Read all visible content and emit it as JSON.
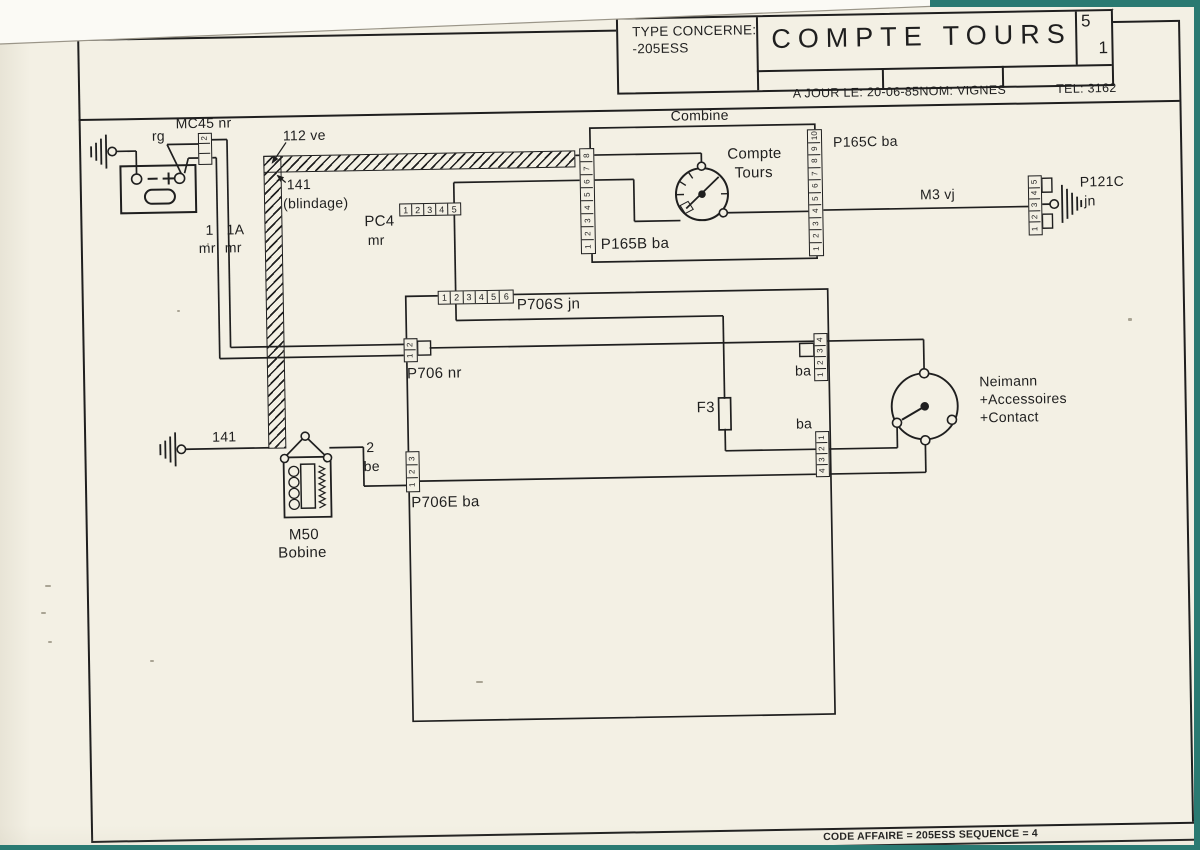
{
  "colors": {
    "paper": "#f3f0e4",
    "ink": "#1f1f1f",
    "scanner_teal": "#2a7a72"
  },
  "title_block": {
    "type_label": "TYPE CONCERNE:",
    "type_value": "-205ESS",
    "title": "COMPTE TOURS",
    "sheet_top": "5",
    "sheet_bottom": "1",
    "date_label": "A JOUR LE:",
    "date_value": "20-06-85",
    "name_label": "NOM:",
    "name_value": "VIGNES",
    "tel_label": "TEL:",
    "tel_value": "3162"
  },
  "footer": {
    "code_line": "CODE AFFAIRE = 205ESS SEQUENCE = 4"
  },
  "diagram": {
    "labels": [
      {
        "t": "MC45 nr",
        "x": 181,
        "y": 109,
        "fs": 14
      },
      {
        "t": "rg",
        "x": 157,
        "y": 121,
        "fs": 14
      },
      {
        "t": "112 ve",
        "x": 288,
        "y": 123,
        "fs": 14
      },
      {
        "t": "141",
        "x": 291,
        "y": 172,
        "fs": 14
      },
      {
        "t": "(blindage)",
        "x": 287,
        "y": 191,
        "fs": 14
      },
      {
        "t": "1",
        "x": 209,
        "y": 216,
        "fs": 14
      },
      {
        "t": "mr",
        "x": 202,
        "y": 234,
        "fs": 14
      },
      {
        "t": "1A",
        "x": 230,
        "y": 216,
        "fs": 14
      },
      {
        "t": "mr",
        "x": 228,
        "y": 234,
        "fs": 14
      },
      {
        "t": "PC4",
        "x": 368,
        "y": 210,
        "fs": 15
      },
      {
        "t": "mr",
        "x": 371,
        "y": 229,
        "fs": 14
      },
      {
        "t": "Combine",
        "x": 676,
        "y": 110,
        "fs": 14
      },
      {
        "t": "Compte",
        "x": 732,
        "y": 149,
        "fs": 15
      },
      {
        "t": "Tours",
        "x": 739,
        "y": 168,
        "fs": 15
      },
      {
        "t": "P165C ba",
        "x": 838,
        "y": 139,
        "fs": 14
      },
      {
        "t": "P165B ba",
        "x": 604,
        "y": 237,
        "fs": 15
      },
      {
        "t": "M3 vj",
        "x": 924,
        "y": 193,
        "fs": 14
      },
      {
        "t": "P121C",
        "x": 1084,
        "y": 183,
        "fs": 14
      },
      {
        "t": "jn",
        "x": 1088,
        "y": 202,
        "fs": 14
      },
      {
        "t": "P706S jn",
        "x": 519,
        "y": 296,
        "fs": 15
      },
      {
        "t": "P706 nr",
        "x": 408,
        "y": 363,
        "fs": 15
      },
      {
        "t": "F3",
        "x": 697,
        "y": 402,
        "fs": 15
      },
      {
        "t": "ba",
        "x": 796,
        "y": 367,
        "fs": 14
      },
      {
        "t": "ba",
        "x": 796,
        "y": 420,
        "fs": 14
      },
      {
        "t": "Neimann",
        "x": 980,
        "y": 381,
        "fs": 14
      },
      {
        "t": "+Accessoires",
        "x": 980,
        "y": 399,
        "fs": 14
      },
      {
        "t": "+Contact",
        "x": 980,
        "y": 417,
        "fs": 14
      },
      {
        "t": "141",
        "x": 212,
        "y": 423,
        "fs": 14
      },
      {
        "t": "M50",
        "x": 287,
        "y": 522,
        "fs": 15
      },
      {
        "t": "Bobine",
        "x": 276,
        "y": 540,
        "fs": 15
      },
      {
        "t": "2",
        "x": 366,
        "y": 436,
        "fs": 14
      },
      {
        "t": "be",
        "x": 363,
        "y": 455,
        "fs": 14
      },
      {
        "t": "P706E ba",
        "x": 410,
        "y": 492,
        "fs": 15
      }
    ],
    "connectors": [
      {
        "name": "MC45",
        "x": 203,
        "y": 126,
        "orient": "v",
        "cw": 14,
        "ch": 10,
        "pins": [
          "2",
          "",
          ""
        ]
      },
      {
        "name": "PC4",
        "x": 403,
        "y": 200,
        "orient": "h",
        "cw": 12,
        "ch": 13,
        "pins": [
          "1",
          "2",
          "3",
          "4",
          "5"
        ]
      },
      {
        "name": "P165B",
        "x": 584,
        "y": 148,
        "orient": "v",
        "cw": 15,
        "ch": 13,
        "pins": [
          "8",
          "7",
          "6",
          "5",
          "4",
          "3",
          "2",
          "1"
        ]
      },
      {
        "name": "P165C",
        "x": 812,
        "y": 133,
        "orient": "v",
        "cw": 15,
        "ch": 12.5,
        "pins": [
          "10",
          "9",
          "8",
          "7",
          "6",
          "5",
          "4",
          "3",
          "2",
          "1"
        ]
      },
      {
        "name": "P121C",
        "x": 1032,
        "y": 183,
        "orient": "v",
        "cw": 14,
        "ch": 11.6,
        "pins": [
          "5",
          "4",
          "3",
          "2",
          "1"
        ]
      },
      {
        "name": "P706S",
        "x": 440,
        "y": 288,
        "orient": "h",
        "cw": 12.3,
        "ch": 14,
        "pins": [
          "1",
          "2",
          "3",
          "4",
          "5",
          "6"
        ]
      },
      {
        "name": "P706",
        "x": 405,
        "y": 335,
        "orient": "v",
        "cw": 14,
        "ch": 11,
        "pins": [
          "2",
          "1"
        ]
      },
      {
        "name": "P706E",
        "x": 405,
        "y": 448,
        "orient": "v",
        "cw": 14,
        "ch": 13,
        "pins": [
          "3",
          "2",
          "1"
        ]
      },
      {
        "name": "BA-UPPER",
        "x": 815,
        "y": 337,
        "orient": "v",
        "cw": 14,
        "ch": 11.5,
        "pins": [
          "4",
          "3",
          "2",
          "1"
        ]
      },
      {
        "name": "BA-LOWER",
        "x": 815,
        "y": 435,
        "orient": "v",
        "cw": 14,
        "ch": 11,
        "pins": [
          "1",
          "2",
          "3",
          "4"
        ]
      }
    ],
    "wires": [
      [
        120,
        143,
        141,
        143
      ],
      [
        141,
        143,
        141,
        167
      ],
      [
        186,
        167,
        172,
        137
      ],
      [
        172,
        137,
        203,
        137
      ],
      [
        189,
        166,
        193,
        151
      ],
      [
        193,
        151,
        203,
        151
      ],
      [
        217,
        133,
        232,
        133
      ],
      [
        232,
        133,
        232,
        341
      ],
      [
        232,
        341,
        406,
        341
      ],
      [
        217,
        151,
        221,
        151
      ],
      [
        221,
        151,
        221,
        352
      ],
      [
        221,
        352,
        406,
        352
      ],
      [
        580,
        155,
        585,
        155
      ],
      [
        598,
        155,
        706,
        155
      ],
      [
        706,
        155,
        706,
        164
      ],
      [
        584,
        180,
        458,
        180
      ],
      [
        458,
        180,
        458,
        290
      ],
      [
        598,
        180,
        638,
        180
      ],
      [
        638,
        180,
        638,
        222
      ],
      [
        638,
        222,
        684,
        222
      ],
      [
        730,
        215,
        813,
        215
      ],
      [
        827,
        214,
        1033,
        214
      ],
      [
        1045,
        212,
        1054,
        212
      ],
      [
        458,
        301,
        458,
        318
      ],
      [
        458,
        318,
        725,
        318
      ],
      [
        725,
        318,
        725,
        401
      ],
      [
        725,
        431,
        725,
        453
      ],
      [
        725,
        453,
        897,
        453
      ],
      [
        897,
        453,
        897,
        432
      ],
      [
        431,
        345,
        925,
        345
      ],
      [
        925,
        345,
        925,
        375
      ],
      [
        329,
        443,
        363,
        443
      ],
      [
        363,
        443,
        363,
        482
      ],
      [
        363,
        482,
        406,
        482
      ],
      [
        419,
        478,
        925,
        478
      ],
      [
        925,
        478,
        925,
        450
      ],
      [
        185,
        442,
        269,
        442
      ]
    ],
    "boxes": [
      [
        595,
        128,
        225,
        134
      ],
      [
        408,
        293,
        422,
        425
      ],
      [
        719,
        400,
        12,
        32
      ]
    ],
    "hooks": [
      [
        419,
        338,
        13,
        14
      ],
      [
        801,
        347,
        14,
        13
      ],
      [
        1046,
        186,
        10,
        14
      ],
      [
        1046,
        222,
        10,
        14
      ]
    ],
    "shield": {
      "h": [
        268,
        150,
        312,
        17
      ],
      "v": [
        268,
        150,
        18,
        293
      ]
    }
  }
}
